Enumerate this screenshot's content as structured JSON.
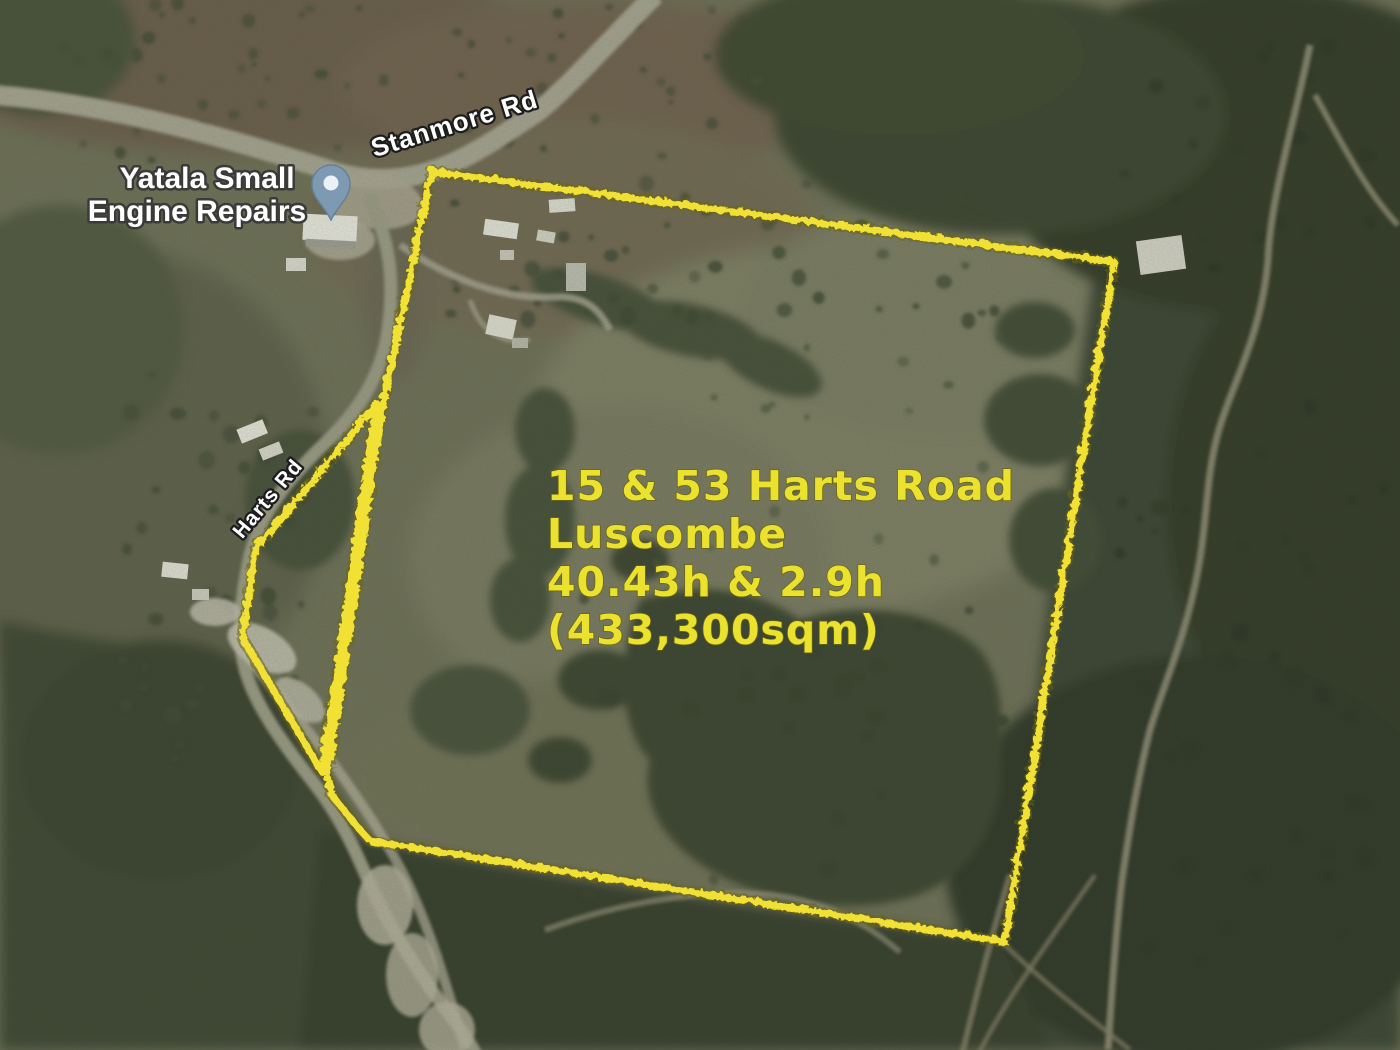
{
  "poi_label": {
    "line1": "Yatala Small",
    "line2": "Engine Repairs"
  },
  "road_labels": {
    "stanmore": "Stanmore Rd",
    "harts": "Harts Rd"
  },
  "annotation": {
    "line1": "15 & 53 Harts Road",
    "line2": "Luscombe",
    "line3": "40.43h & 2.9h",
    "line4": "(433,300sqm)"
  },
  "colors": {
    "boundary_yellow": "#f2e134",
    "annotation_yellow": "#eae22f",
    "pin_blue": "#7e9ab2",
    "label_white": "#ffffff"
  }
}
